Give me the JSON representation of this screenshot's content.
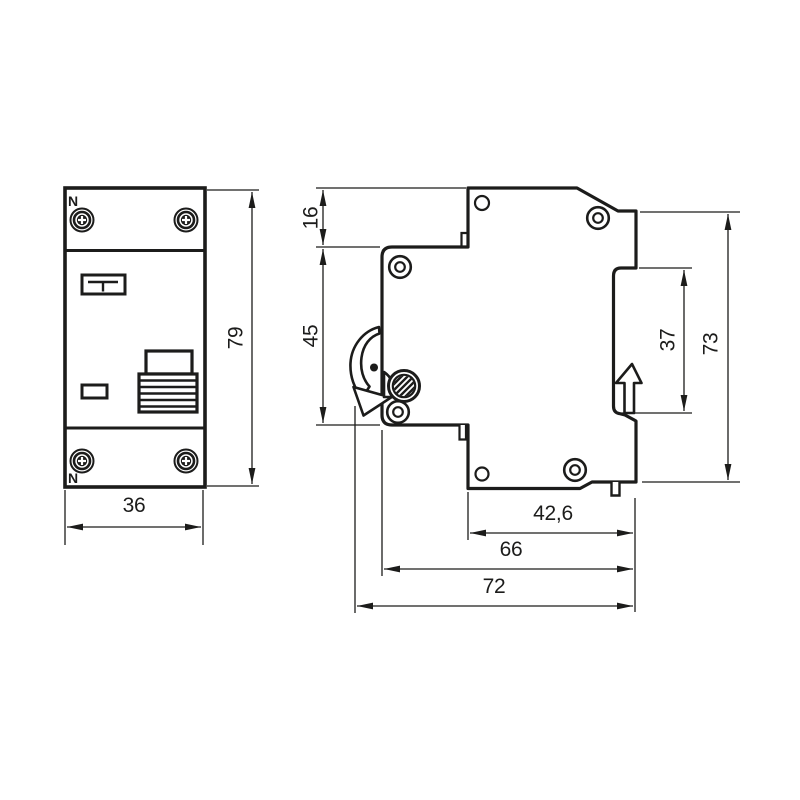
{
  "drawing": {
    "ink_color": "#1c1c1b",
    "background_color": "#ffffff",
    "front_view": {
      "neutral_label_top": "N",
      "neutral_label_bottom": "N",
      "dim_height": "79",
      "dim_width": "36"
    },
    "side_view": {
      "dim_top_step": "16",
      "dim_front_face": "45",
      "dim_rail_groove": "37",
      "dim_back_height": "73",
      "dim_bottom_step": "42,6",
      "dim_body_depth": "66",
      "dim_overall_depth": "72"
    }
  }
}
